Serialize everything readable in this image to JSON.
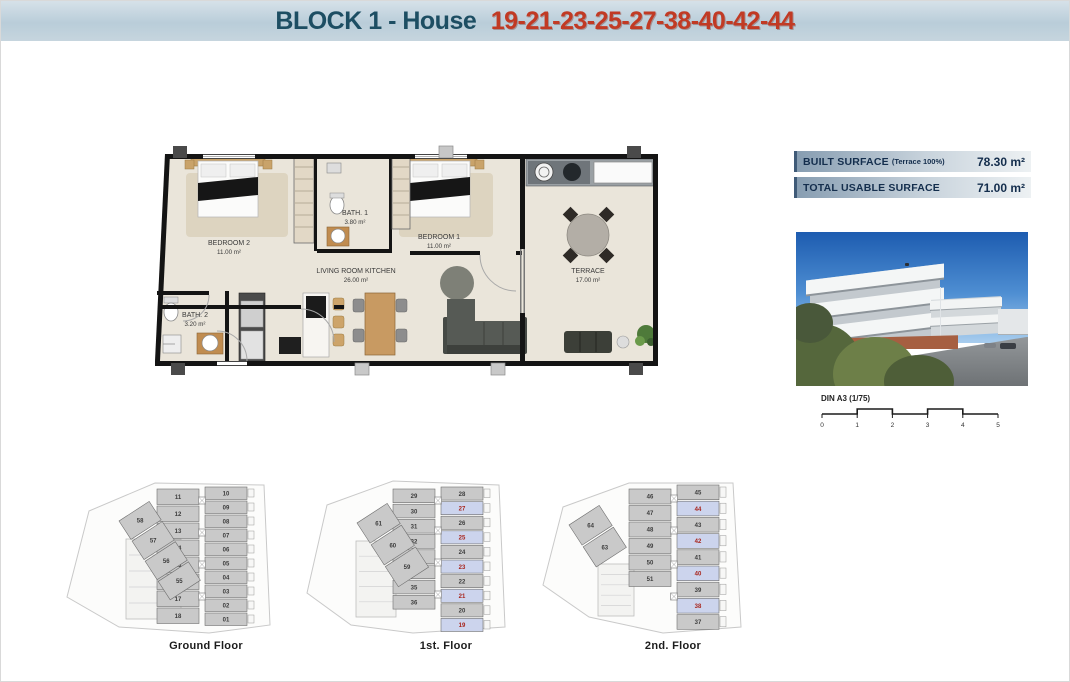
{
  "header": {
    "block_label": "BLOCK 1 - House",
    "house_numbers": "19-21-23-25-27-38-40-42-44"
  },
  "floorplan": {
    "rooms": [
      {
        "name": "BEDROOM 2",
        "area": "11.00 m²"
      },
      {
        "name": "BATH. 1",
        "area": "3.80 m²"
      },
      {
        "name": "BEDROOM 1",
        "area": "11.00 m²"
      },
      {
        "name": "LIVING ROOM KITCHEN",
        "area": "26.00 m²"
      },
      {
        "name": "BATH. 2",
        "area": "3.20 m²"
      },
      {
        "name": "TERRACE",
        "area": "17.00 m²"
      }
    ]
  },
  "surface_table": {
    "rows": [
      {
        "label": "BUILT SURFACE",
        "note": "(Terrace 100%)",
        "value": "78.30 m²"
      },
      {
        "label": "TOTAL USABLE SURFACE",
        "note": "",
        "value": "71.00 m²"
      }
    ]
  },
  "scale_bar": {
    "label": "DIN A3 (1/75)",
    "ticks": [
      "0",
      "1",
      "2",
      "3",
      "4",
      "5"
    ]
  },
  "floors": [
    {
      "label": "Ground Floor",
      "left_units": [
        "11",
        "12",
        "13",
        "14",
        "15",
        "16",
        "17",
        "18"
      ],
      "right_units": [
        {
          "n": "10",
          "hl": false
        },
        {
          "n": "09",
          "hl": false
        },
        {
          "n": "08",
          "hl": false
        },
        {
          "n": "07",
          "hl": false
        },
        {
          "n": "06",
          "hl": false
        },
        {
          "n": "05",
          "hl": false
        },
        {
          "n": "04",
          "hl": false
        },
        {
          "n": "03",
          "hl": false
        },
        {
          "n": "02",
          "hl": false
        },
        {
          "n": "01",
          "hl": false
        }
      ],
      "annex_units": [
        "58",
        "57",
        "56",
        "55"
      ]
    },
    {
      "label": "1st. Floor",
      "left_units": [
        "29",
        "30",
        "31",
        "32",
        "33",
        "34",
        "35",
        "36"
      ],
      "right_units": [
        {
          "n": "28",
          "hl": false
        },
        {
          "n": "27",
          "hl": true
        },
        {
          "n": "26",
          "hl": false
        },
        {
          "n": "25",
          "hl": true
        },
        {
          "n": "24",
          "hl": false
        },
        {
          "n": "23",
          "hl": true
        },
        {
          "n": "22",
          "hl": false
        },
        {
          "n": "21",
          "hl": true
        },
        {
          "n": "20",
          "hl": false
        },
        {
          "n": "19",
          "hl": true
        }
      ],
      "annex_units": [
        "61",
        "60",
        "59"
      ]
    },
    {
      "label": "2nd. Floor",
      "left_units": [
        "46",
        "47",
        "48",
        "49",
        "50",
        "51"
      ],
      "right_units": [
        {
          "n": "45",
          "hl": false
        },
        {
          "n": "44",
          "hl": true
        },
        {
          "n": "43",
          "hl": false
        },
        {
          "n": "42",
          "hl": true
        },
        {
          "n": "41",
          "hl": false
        },
        {
          "n": "40",
          "hl": true
        },
        {
          "n": "39",
          "hl": false
        },
        {
          "n": "38",
          "hl": true
        },
        {
          "n": "37",
          "hl": false
        }
      ],
      "annex_units": [
        "64",
        "63"
      ]
    }
  ],
  "colors": {
    "title_blue": "#1d4e63",
    "title_red": "#c13a24",
    "table_text": "#142e4d",
    "highlight_cell": "#ccd4ed",
    "highlight_number": "#a8241c",
    "unit_gray": "#c9c9c9"
  }
}
